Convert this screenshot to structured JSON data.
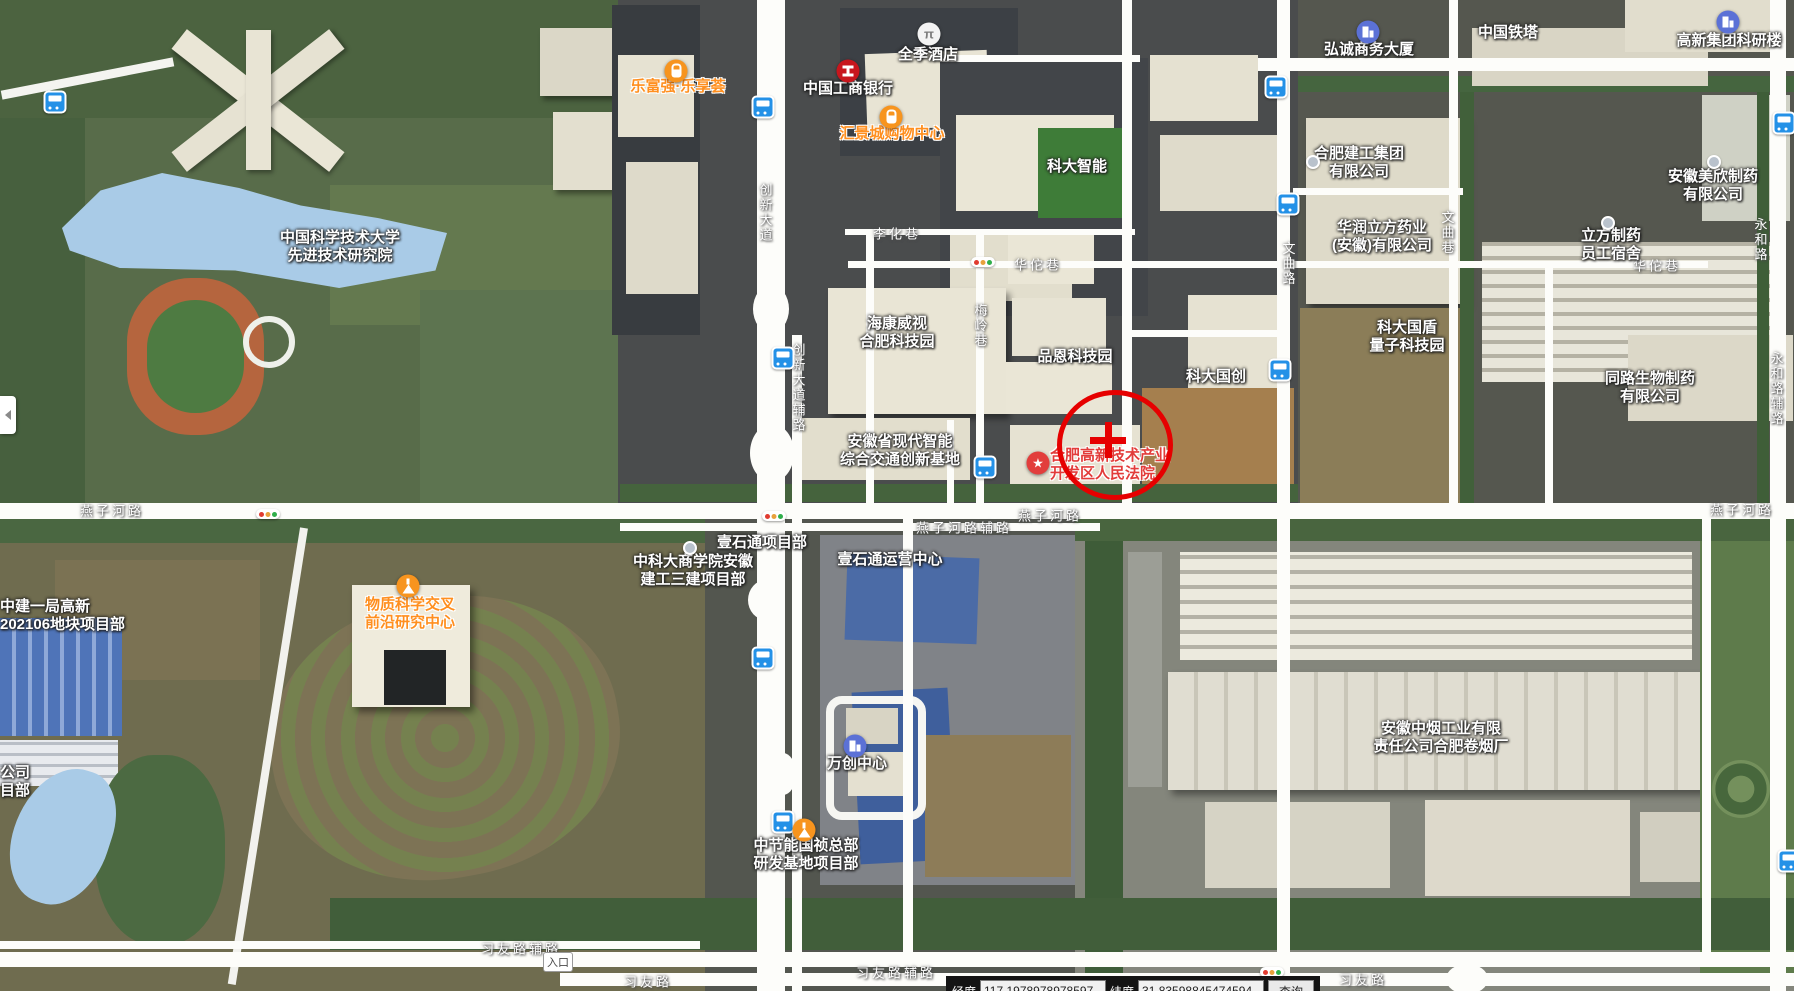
{
  "map": {
    "poi_labels": [
      {
        "id": "ustc-advanced-institute",
        "lines": [
          "中国科学技术大学",
          "先进技术研究院"
        ],
        "style": "white",
        "x": 340,
        "y": 247
      },
      {
        "id": "lefuqiang-lexianghui",
        "lines": [
          "乐富强·乐享荟"
        ],
        "style": "orange",
        "x": 678,
        "y": 87
      },
      {
        "id": "icbc-bank",
        "lines": [
          "中国工商银行"
        ],
        "style": "white",
        "x": 848,
        "y": 89
      },
      {
        "id": "ji-hotel",
        "lines": [
          "全季酒店"
        ],
        "style": "white",
        "x": 928,
        "y": 55
      },
      {
        "id": "huijingcheng-mall",
        "lines": [
          "汇景城购物中心"
        ],
        "style": "orange",
        "x": 892,
        "y": 134
      },
      {
        "id": "keda-zhineng",
        "lines": [
          "科大智能"
        ],
        "style": "white",
        "x": 1077,
        "y": 167
      },
      {
        "id": "hongcheng-tower",
        "lines": [
          "弘诚商务大厦"
        ],
        "style": "white",
        "x": 1369,
        "y": 50
      },
      {
        "id": "china-tower",
        "lines": [
          "中国铁塔"
        ],
        "style": "white",
        "x": 1508,
        "y": 33
      },
      {
        "id": "gaoxin-research-building",
        "lines": [
          "高新集团科研楼"
        ],
        "style": "white",
        "x": 1729,
        "y": 41
      },
      {
        "id": "hefei-construction-group",
        "lines": [
          "合肥建工集团",
          "有限公司"
        ],
        "style": "white",
        "x": 1359,
        "y": 163
      },
      {
        "id": "huarun-lifang-pharma",
        "lines": [
          "华润立方药业",
          "(安徽)有限公司"
        ],
        "style": "white",
        "x": 1382,
        "y": 237
      },
      {
        "id": "meixin-pharma",
        "lines": [
          "安徽美欣制药",
          "有限公司"
        ],
        "style": "white",
        "x": 1713,
        "y": 186
      },
      {
        "id": "lifang-dormitory",
        "lines": [
          "立方制药",
          "员工宿舍"
        ],
        "style": "white",
        "x": 1611,
        "y": 245
      },
      {
        "id": "hikvision-park",
        "lines": [
          "海康威视",
          "合肥科技园"
        ],
        "style": "white",
        "x": 897,
        "y": 333
      },
      {
        "id": "pinen-tech-park",
        "lines": [
          "品恩科技园"
        ],
        "style": "white",
        "x": 1075,
        "y": 357
      },
      {
        "id": "keda-guochuang",
        "lines": [
          "科大国创"
        ],
        "style": "white",
        "x": 1216,
        "y": 377
      },
      {
        "id": "guodun-quantum-park",
        "lines": [
          "科大国盾",
          "量子科技园"
        ],
        "style": "white",
        "x": 1407,
        "y": 337
      },
      {
        "id": "tonglu-bio-pharma",
        "lines": [
          "同路生物制药",
          "有限公司"
        ],
        "style": "white",
        "x": 1650,
        "y": 388
      },
      {
        "id": "anhui-transport-base",
        "lines": [
          "安徽省现代智能",
          "综合交通创新基地"
        ],
        "style": "white",
        "x": 900,
        "y": 451
      },
      {
        "id": "hightech-court",
        "lines": [
          "合肥高新技术产业",
          "开发区人民法院"
        ],
        "style": "red",
        "x": 1050,
        "y": 465,
        "anchor": "left"
      },
      {
        "id": "matter-science-center",
        "lines": [
          "物质科学交叉",
          "前沿研究中心"
        ],
        "style": "orange",
        "x": 410,
        "y": 614
      },
      {
        "id": "zhongjian-site",
        "lines": [
          "中建一局高新",
          "202106地块项目部"
        ],
        "style": "white",
        "x": 0,
        "y": 616,
        "anchor": "left"
      },
      {
        "id": "ustc-business-school-site",
        "lines": [
          "中科大商学院安徽",
          "建工三建项目部"
        ],
        "style": "white",
        "x": 693,
        "y": 571
      },
      {
        "id": "yishitong-project",
        "lines": [
          "壹石通项目部"
        ],
        "style": "white",
        "x": 762,
        "y": 543
      },
      {
        "id": "yishitong-operations",
        "lines": [
          "壹石通运营中心"
        ],
        "style": "white",
        "x": 890,
        "y": 560
      },
      {
        "id": "wanchuang-center",
        "lines": [
          "万创中心"
        ],
        "style": "white",
        "x": 857,
        "y": 764
      },
      {
        "id": "zhongjieneng-site",
        "lines": [
          "中节能国祯总部",
          "研发基地项目部"
        ],
        "style": "white",
        "x": 806,
        "y": 855
      },
      {
        "id": "anhui-tobacco-factory",
        "lines": [
          "安徽中烟工业有限",
          "责任公司合肥卷烟厂"
        ],
        "style": "white",
        "x": 1441,
        "y": 738
      },
      {
        "id": "edge-clipped-label",
        "lines": [
          "公司",
          "目部"
        ],
        "style": "white",
        "x": 0,
        "y": 782,
        "anchor": "left"
      }
    ],
    "poi_icons": [
      {
        "type": "bag",
        "x": 676,
        "y": 71
      },
      {
        "type": "bank",
        "x": 848,
        "y": 71
      },
      {
        "type": "hotel",
        "x": 929,
        "y": 34,
        "glyph": "π"
      },
      {
        "type": "bag",
        "x": 891,
        "y": 117
      },
      {
        "type": "building",
        "x": 1368,
        "y": 32
      },
      {
        "type": "building",
        "x": 1728,
        "y": 22
      },
      {
        "type": "star",
        "x": 1038,
        "y": 463,
        "glyph": "★"
      },
      {
        "type": "flask",
        "x": 408,
        "y": 586
      },
      {
        "type": "building",
        "x": 855,
        "y": 746
      },
      {
        "type": "flask",
        "x": 804,
        "y": 830
      },
      {
        "type": "dot",
        "x": 1313,
        "y": 162
      },
      {
        "type": "dot",
        "x": 1714,
        "y": 162
      },
      {
        "type": "dot",
        "x": 1608,
        "y": 223
      },
      {
        "type": "dot",
        "x": 690,
        "y": 548
      }
    ],
    "road_labels": [
      {
        "text": "燕子河路",
        "x": 112,
        "y": 510
      },
      {
        "text": "燕子河路辅路",
        "x": 964,
        "y": 527
      },
      {
        "text": "燕子河路",
        "x": 1050,
        "y": 515
      },
      {
        "text": "燕子河路",
        "x": 1742,
        "y": 509
      },
      {
        "text": "习友路辅路",
        "x": 521,
        "y": 948
      },
      {
        "text": "习友路",
        "x": 648,
        "y": 981
      },
      {
        "text": "习友路辅路",
        "x": 896,
        "y": 972
      },
      {
        "text": "习友路",
        "x": 1363,
        "y": 979
      },
      {
        "text": "华佗巷",
        "x": 1038,
        "y": 264
      },
      {
        "text": "华佗巷",
        "x": 1657,
        "y": 265
      },
      {
        "text": "李化巷",
        "x": 897,
        "y": 233
      },
      {
        "text": "创新大道",
        "x": 765,
        "y": 213,
        "vertical": true
      },
      {
        "text": "创新大道辅路",
        "x": 798,
        "y": 388,
        "vertical": true
      },
      {
        "text": "梅岭巷",
        "x": 980,
        "y": 326,
        "vertical": true
      },
      {
        "text": "文曲路",
        "x": 1288,
        "y": 264,
        "vertical": true
      },
      {
        "text": "文曲巷",
        "x": 1447,
        "y": 233,
        "vertical": true
      },
      {
        "text": "永和路",
        "x": 1760,
        "y": 240,
        "vertical": true
      },
      {
        "text": "永和路辅路",
        "x": 1776,
        "y": 389,
        "vertical": true
      }
    ],
    "bus_stops": [
      {
        "x": 55,
        "y": 102
      },
      {
        "x": 763,
        "y": 107
      },
      {
        "x": 1276,
        "y": 87
      },
      {
        "x": 1784,
        "y": 123
      },
      {
        "x": 1288,
        "y": 204
      },
      {
        "x": 1280,
        "y": 370
      },
      {
        "x": 783,
        "y": 358
      },
      {
        "x": 985,
        "y": 467
      },
      {
        "x": 763,
        "y": 658
      },
      {
        "x": 783,
        "y": 822
      },
      {
        "x": 1789,
        "y": 861
      }
    ],
    "traffic_lights": [
      {
        "x": 268,
        "y": 514
      },
      {
        "x": 983,
        "y": 262
      },
      {
        "x": 774,
        "y": 516
      },
      {
        "x": 1272,
        "y": 972
      }
    ],
    "entrance_badge": {
      "text": "入口",
      "x": 558,
      "y": 962
    },
    "target_marker": {
      "x": 1110,
      "y": 443,
      "radius": 53,
      "color": "#e60000"
    }
  },
  "statusbar": {
    "lon_label": "经度",
    "lon_value": "117.1978978978597",
    "lat_label": "纬度",
    "lat_value": "31.83598845474594",
    "search_button": "查询"
  },
  "colors": {
    "poi_white": "#ffffff",
    "poi_orange": "#ff8f1f",
    "poi_red": "#e23c3a",
    "bus_blue": "#2491e7",
    "target_red": "#e60000",
    "road_white": "#fdfdfa"
  }
}
